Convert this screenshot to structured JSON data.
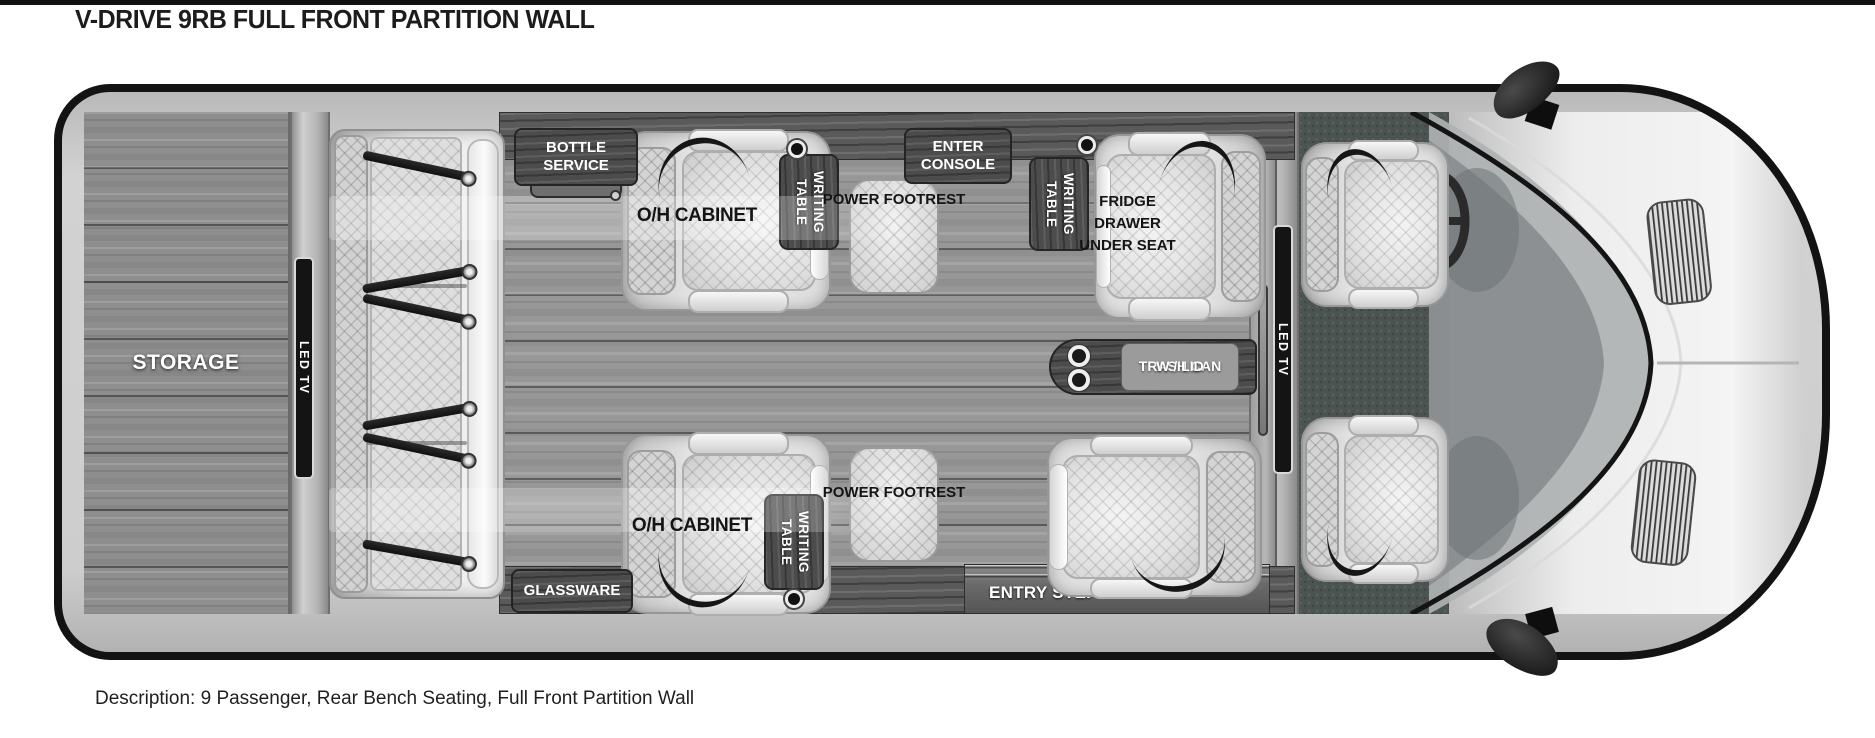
{
  "page": {
    "title": "V-DRIVE 9RB FULL FRONT PARTITION WALL",
    "description": "Description: 9 Passenger, Rear Bench Seating, Full Front Partition Wall"
  },
  "floorplan": {
    "storage": "STORAGE",
    "led_tv_rear": "LED TV",
    "led_tv_front": "LED TV",
    "bottle_service": "BOTTLE SERVICE",
    "enter_console": "ENTER CONSOLE",
    "oh_cabinet_top": "O/H CABINET",
    "oh_cabinet_bottom": "O/H CABINET",
    "writing_table_top_left": "WRITING TABLE",
    "writing_table_top_right": "WRITING TABLE",
    "writing_table_bottom": "WRITING TABLE",
    "power_footrest_top": "POWER FOOTREST",
    "power_footrest_bottom": "POWER FOOTREST",
    "fridge_drawer": "FRIDGE DRAWER UNDER SEAT",
    "trash_can_line1": "TRASH CAN",
    "trash_can_line2": "W / LID",
    "glassware": "GLASSWARE",
    "entry_step": "ENTRY STEP"
  },
  "colors": {
    "outline": "#131313",
    "floor_wood": "#979797",
    "cabinet_wood": "#4c4c4c",
    "seat_light": "#e8e8e8",
    "carpet": "#4b5450",
    "label_text": "#ffffff"
  }
}
